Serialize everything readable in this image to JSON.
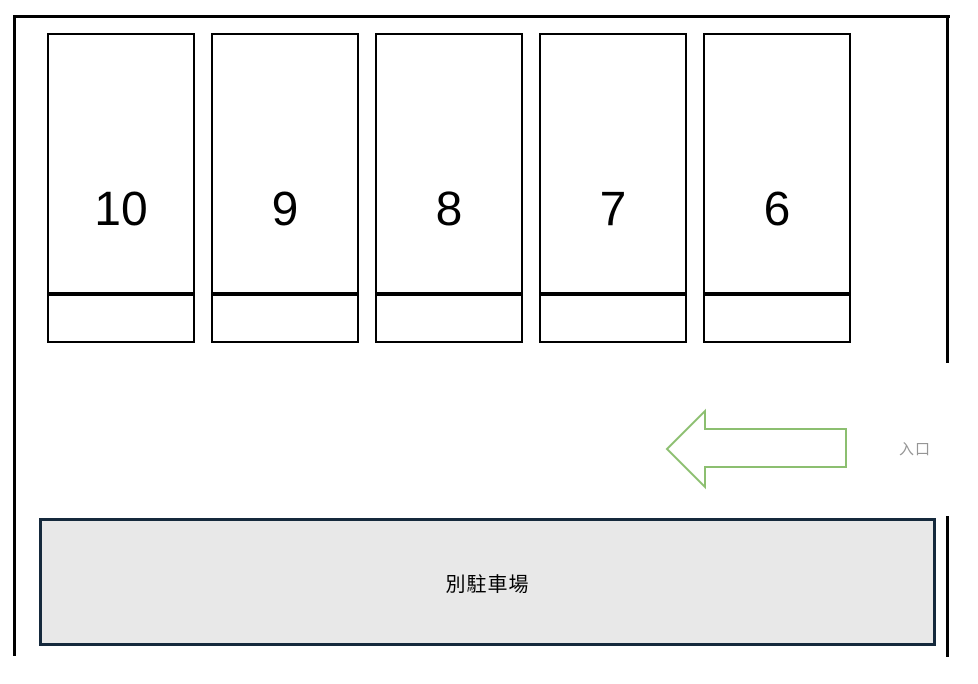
{
  "diagram_title": "parking-lot-layout",
  "stalls": {
    "labels": [
      "10",
      "9",
      "8",
      "7",
      "6"
    ]
  },
  "entrance": {
    "label": "入口",
    "arrow_direction": "left"
  },
  "annex": {
    "label": "別駐車場"
  },
  "colors": {
    "wall_black": "#000000",
    "arrow_green": "#8cbf70",
    "entrance_gray": "#969696",
    "annex_border": "#15293c",
    "annex_fill": "#e8e8e8"
  }
}
